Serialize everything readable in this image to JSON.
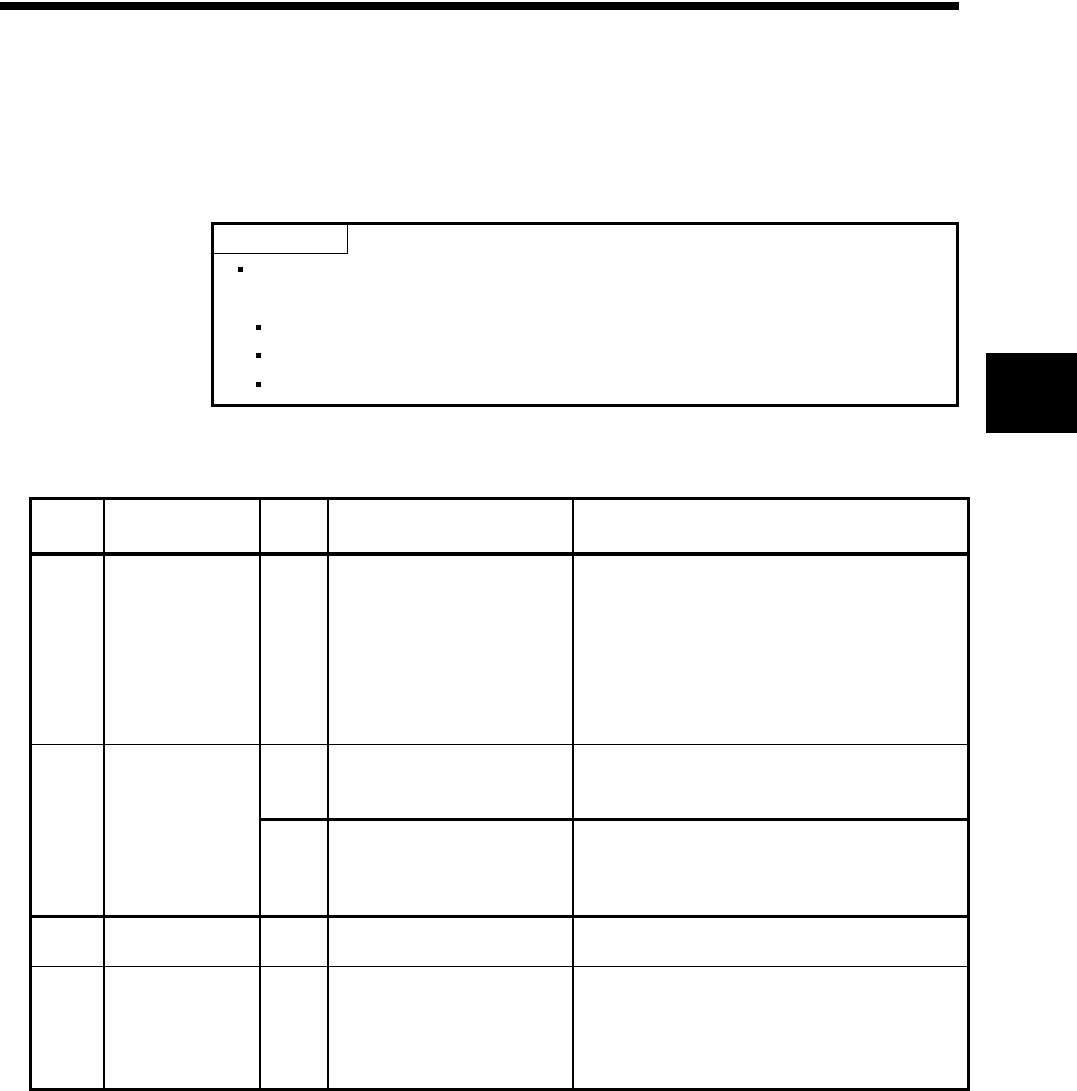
{
  "page": {
    "kind": "scanned-manual-page",
    "background_color": "#ffffff",
    "ink_color": "#000000"
  },
  "top_rule": {
    "label": ""
  },
  "note_box": {
    "label": "",
    "items": [
      {
        "marker": "bullet-square",
        "text": ""
      },
      {
        "marker": "bullet-square",
        "text": ""
      },
      {
        "marker": "bullet-square",
        "text": ""
      },
      {
        "marker": "bullet-square",
        "text": ""
      }
    ]
  },
  "chapter_tab": {
    "label": ""
  },
  "table": {
    "column_count": 5,
    "headers": [
      "",
      "",
      "",
      "",
      ""
    ],
    "rows": [
      {
        "cells": [
          "",
          "",
          "",
          "",
          ""
        ]
      },
      {
        "cells": [
          "",
          "",
          "",
          "",
          ""
        ],
        "subrow": [
          "",
          "",
          ""
        ]
      },
      {
        "cells": [
          "",
          "",
          "",
          "",
          ""
        ]
      },
      {
        "cells": [
          "",
          "",
          "",
          "",
          ""
        ]
      }
    ]
  }
}
